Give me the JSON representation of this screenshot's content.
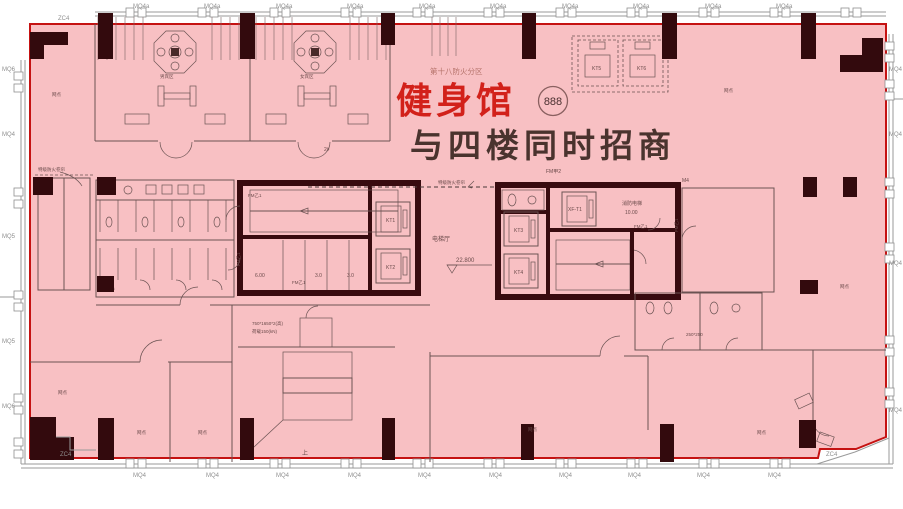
{
  "title": {
    "fire_zone": "第十八防火分区",
    "venue": "健身馆",
    "badge": "888",
    "subtitle": "与四楼同时招商"
  },
  "colors": {
    "highlight_fill": "#f8c0c3",
    "highlight_border": "#c51212",
    "venue_text": "#d2211a",
    "subtitle_text": "#4a332e",
    "wall": "#380b0f"
  },
  "facade": {
    "mq4a": "MQ4a",
    "mq4": "MQ4",
    "mq5": "MQ5",
    "mq6": "MQ6",
    "zc4": "ZC4"
  },
  "equipment": {
    "kt1": "KT1",
    "kt2": "KT2",
    "kt3": "KT3",
    "kt4": "KT4",
    "kt5": "KT5",
    "kt6": "KT6",
    "xf": "XF-T1"
  },
  "core": {
    "hall": "电梯厅",
    "level": "22.800",
    "fire_lift": "消防电梯",
    "fire_lift_level": "10.00",
    "shaft_600": "6.00",
    "shaft_30": "3.0",
    "door_fmb1": "FM乙1",
    "door_fma2": "FM甲2",
    "shutter": "特级防火卷帘",
    "m4": "M4"
  },
  "escalator": {
    "dim": "750*1650*2(高)",
    "load": "荷载150(kN)",
    "up": "上"
  },
  "rooms": {
    "outlet": "网点",
    "mens": "男宾区",
    "womens": "女宾区",
    "tile": "250*250",
    "unit": "2#"
  }
}
